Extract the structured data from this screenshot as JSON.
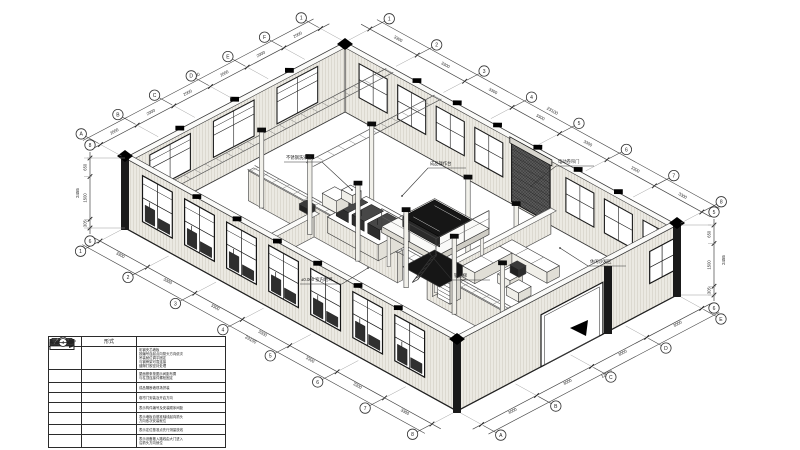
{
  "legend": {
    "col_headers": [
      "图例",
      "形式"
    ],
    "rows": [
      {
        "symbol": "panel-outline",
        "form": "arrow-long",
        "desc": [
          "彩钢夹芯墙板",
          "按编号自起点向箭头方向依次",
          "吊装就位调平固定",
          "与钢骨架可靠连接",
          "缝隙打胶密封处理"
        ]
      },
      {
        "symbol": "panel-dark",
        "form": "plate-dashed",
        "desc": [
          "屋面檩条按图示间距布置",
          "与柱顶连接件螺栓固定"
        ]
      },
      {
        "symbol": "line-double",
        "form": "line-thin",
        "desc": [
          "成品隔断墙现场拼装"
        ]
      },
      {
        "symbol": "panel-hatch",
        "form": "arrow-long",
        "desc": [
          "卷帘门安装及开启方向"
        ]
      },
      {
        "symbol": "bubble-1",
        "form": "dim-200",
        "desc": [
          "表示构件编号及安装顺序间距"
        ]
      },
      {
        "symbol": "bubble-2",
        "form": "arrow-short",
        "desc": [
          "表示墙板自基准轴线起向箭头",
          "方向依次安装就位"
        ]
      },
      {
        "symbol": "bubble-3",
        "form": "dot",
        "desc": [
          "表示定位基准点先行测量放线"
        ]
      },
      {
        "symbol": "bubble-4",
        "form": "arrow-long",
        "desc": [
          "表示设备搬入路线由大门进入",
          "沿箭头方向就位"
        ]
      }
    ]
  },
  "grids": {
    "top_left": [
      "A",
      "B",
      "C",
      "D",
      "E",
      "F",
      "1"
    ],
    "top_right": [
      "1",
      "2",
      "3",
      "4",
      "5",
      "6",
      "7",
      "8"
    ],
    "bottom_front": [
      "1",
      "2",
      "3",
      "4",
      "5",
      "6",
      "7",
      "8"
    ],
    "front_right": [
      "A",
      "B",
      "C",
      "D",
      "E"
    ],
    "left_vertical": [
      "8",
      "6"
    ],
    "right_vertical": [
      "5",
      "6"
    ]
  },
  "dimensions": {
    "top_left": [
      "2000",
      "2000",
      "2000",
      "2000",
      "2000",
      "2000"
    ],
    "top_left_overall": "12000",
    "top_right": [
      "3300",
      "3300",
      "3300",
      "3300",
      "3300",
      "3300",
      "3300"
    ],
    "top_right_overall": "23100",
    "bottom_front": [
      "3300",
      "3300",
      "3300",
      "3300",
      "3300",
      "3300",
      "3300"
    ],
    "bottom_front_overall": "23100",
    "front_right": [
      "3000",
      "3000",
      "3000",
      "3000"
    ],
    "front_right_overall": "12000",
    "left_vertical": [
      "650",
      "1500",
      "305"
    ],
    "left_vertical_overall": "2455",
    "right_vertical": [
      "650",
      "1500",
      "305"
    ],
    "right_vertical_overall": "2455"
  },
  "annotations": [
    {
      "text": "不锈钢洗涤台"
    },
    {
      "text": "成品操作台"
    },
    {
      "text": "钢直梯"
    },
    {
      "text": "休闲沙发区"
    },
    {
      "text": "电动卷帘门"
    },
    {
      "text": "±0.000 室内地坪"
    }
  ],
  "colors": {
    "line": "#333333",
    "wall": "#ebe9e2",
    "dark_column": "#1a1a1a",
    "roller_door": "#4f4f4f",
    "paper": "#ffffff"
  }
}
